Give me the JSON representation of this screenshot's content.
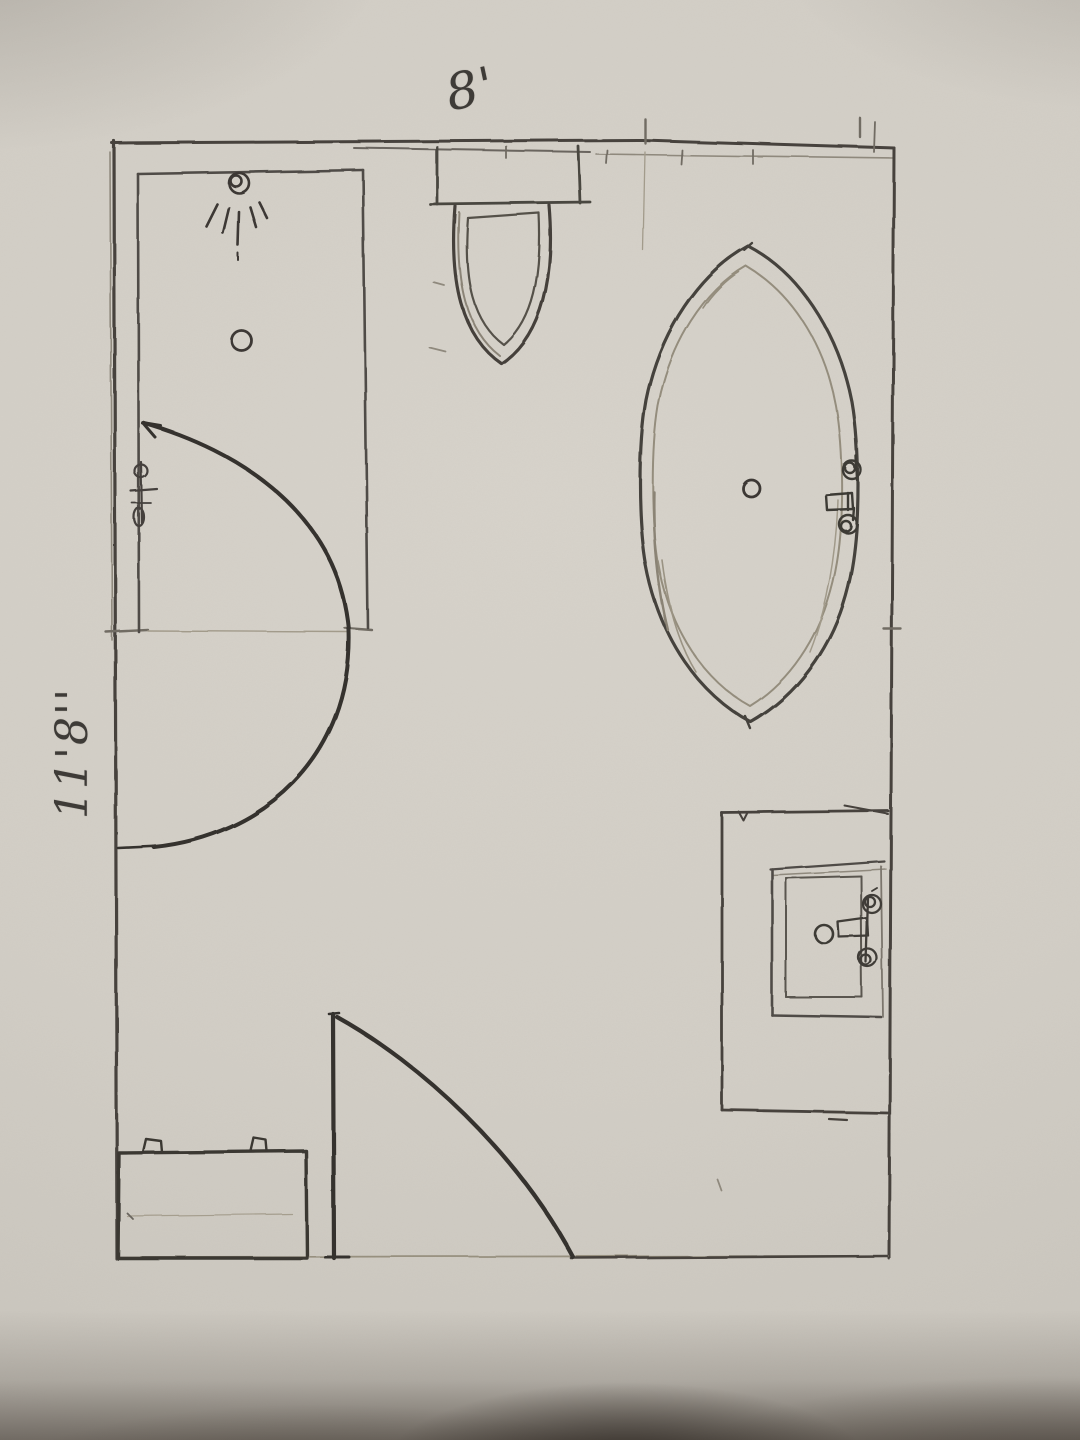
{
  "document": {
    "title": "Hand-drawn bathroom floor plan pencil sketch",
    "room": {
      "width_label": "8'",
      "depth_label": "11'8''"
    }
  },
  "fixtures": [
    "shower-enclosure",
    "shower-head-icon",
    "shower-drain-icon",
    "shower-valve-icon",
    "shower-door-swing-arc",
    "toilet-tank",
    "toilet-bowl",
    "bathtub-oval",
    "tub-drain-icon",
    "tub-faucet-icon",
    "vanity-counter",
    "sink-basin",
    "sink-drain-icon",
    "sink-faucet-icon",
    "entry-door-leaf",
    "entry-door-swing-arc",
    "storage-cabinet"
  ],
  "colors": {
    "paper": "#d3cfc7",
    "pencil_dark": "#36332f",
    "pencil_medium": "#57534e",
    "pencil_faint": "#9a9283"
  }
}
